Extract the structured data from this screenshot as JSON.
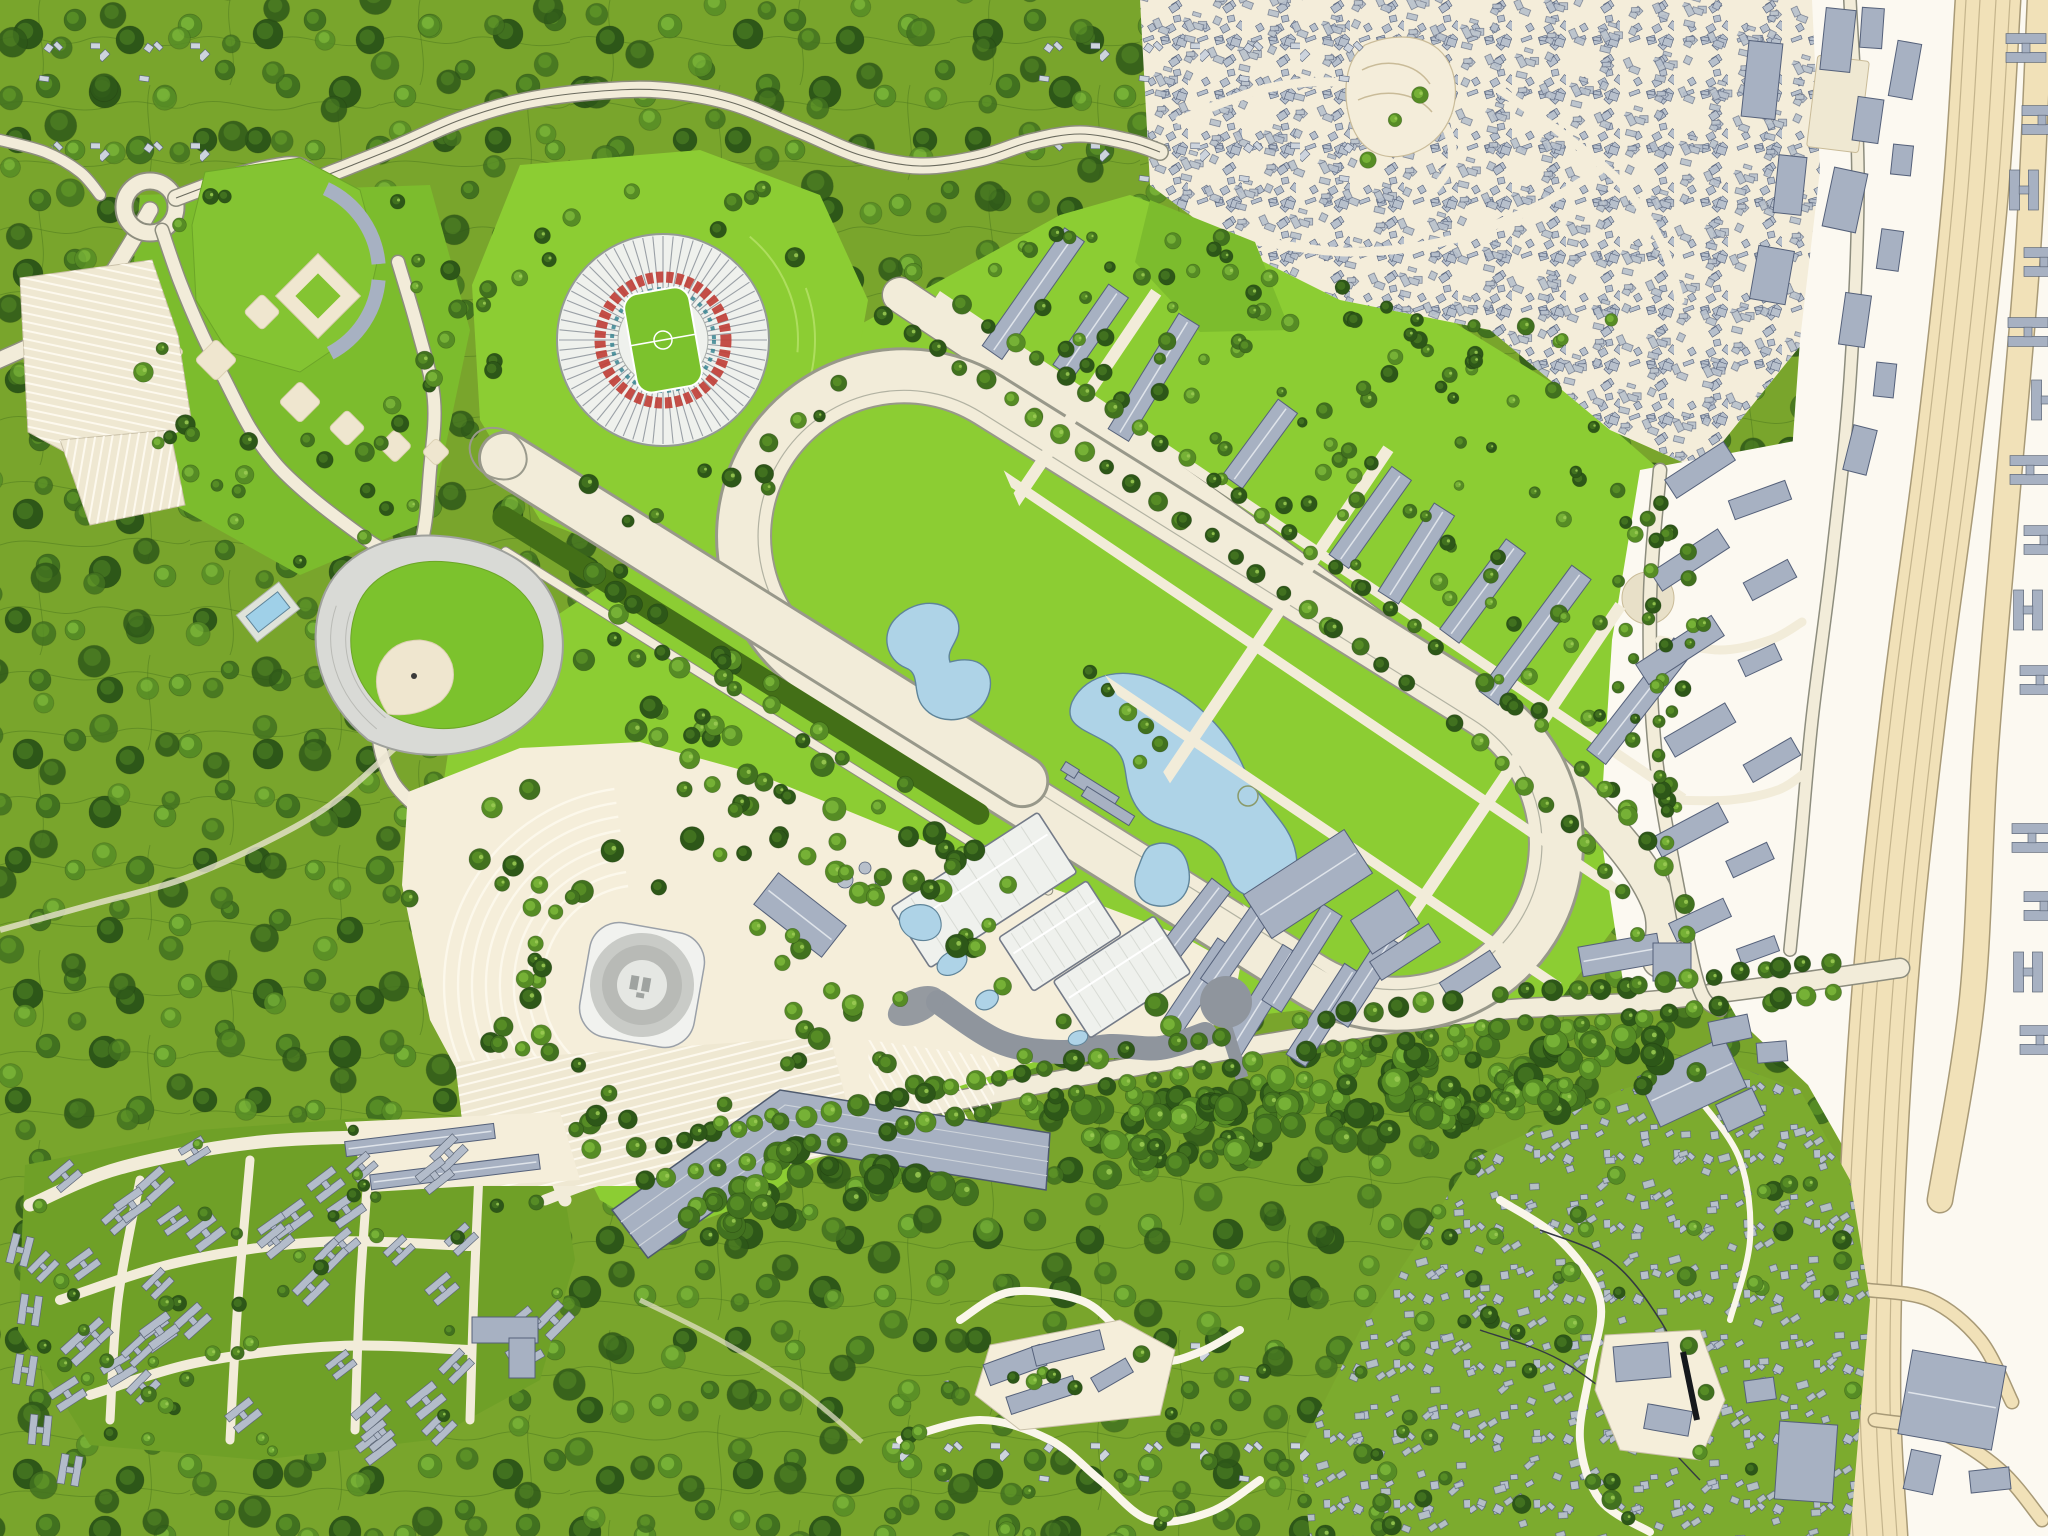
{
  "map": {
    "kind": "master-plan site map",
    "scale_mark": {
      "present": true,
      "color": "#15181c"
    }
  },
  "palette": {
    "forestBase": "#79a52c",
    "forestContour": "#4c781b",
    "treeDark": "#2d5718",
    "treeMid": "#41711f",
    "treeOlive": "#568c25",
    "treeLight": "#76b136",
    "treeGlint": "#9ccb55",
    "lawnBright": "#8ccd33",
    "lawnMid": "#7cbc2d",
    "hedge": "#436f17",
    "roadCream": "#f2ecd9",
    "roadCasing": "#8d8d7e",
    "plazaCream": "#f5eeda",
    "parkingCream": "#efe8d2",
    "zoneWhite": "#fcf9f1",
    "highwayTan": "#f1e1b8",
    "tanEdge": "#a89a77",
    "bldFill": "#a7b1c2",
    "bldStroke": "#55617a",
    "roofWhite": "#eff1ed",
    "roofStroke": "#747b88",
    "standFill": "#d9dad6",
    "standLine": "#b9bab5",
    "darkPlaza": "#8f959d",
    "water": "#aed3e7",
    "waterEdge": "#5f8499",
    "red": "#c04038",
    "teal": "#2f7f8d",
    "settleFill": "#b7c0cc",
    "paleHouse": "#cdd4dd",
    "fieldGreen": "#7cc22d",
    "ink": "#15181c"
  },
  "features": [
    {
      "id": "forest-hills",
      "label": "forested hills with contour lines"
    },
    {
      "id": "olympic-stadium",
      "label": "round stadium with radial roof spokes and red ring"
    },
    {
      "id": "racetrack",
      "label": "racetrack oval with infield lakes"
    },
    {
      "id": "training-chute",
      "label": "straight training chute with hedge"
    },
    {
      "id": "grandstands",
      "label": "three white grandstand roofs"
    },
    {
      "id": "arena",
      "label": "circular arena on plaza with parking arcs"
    },
    {
      "id": "baseball-stadium",
      "label": "sunken teardrop baseball stadium"
    },
    {
      "id": "ballfields",
      "label": "ballfield training complex with parking"
    },
    {
      "id": "housing-grid",
      "label": "diagonal slab housing blocks"
    },
    {
      "id": "estate",
      "label": "low-rise H-block housing estate"
    },
    {
      "id": "old-town",
      "label": "dense old-town building fabric"
    },
    {
      "id": "hillside-settlement",
      "label": "informal hillside settlement"
    },
    {
      "id": "highway",
      "label": "highway and rail corridor"
    },
    {
      "id": "boulevard",
      "label": "tree-lined boulevard"
    },
    {
      "id": "ponds",
      "label": "blue infield ponds"
    },
    {
      "id": "pool",
      "label": "small swimming pool"
    },
    {
      "id": "roundabout",
      "label": "roundabout on winding road"
    },
    {
      "id": "scale-mark",
      "label": "black scale mark"
    }
  ]
}
